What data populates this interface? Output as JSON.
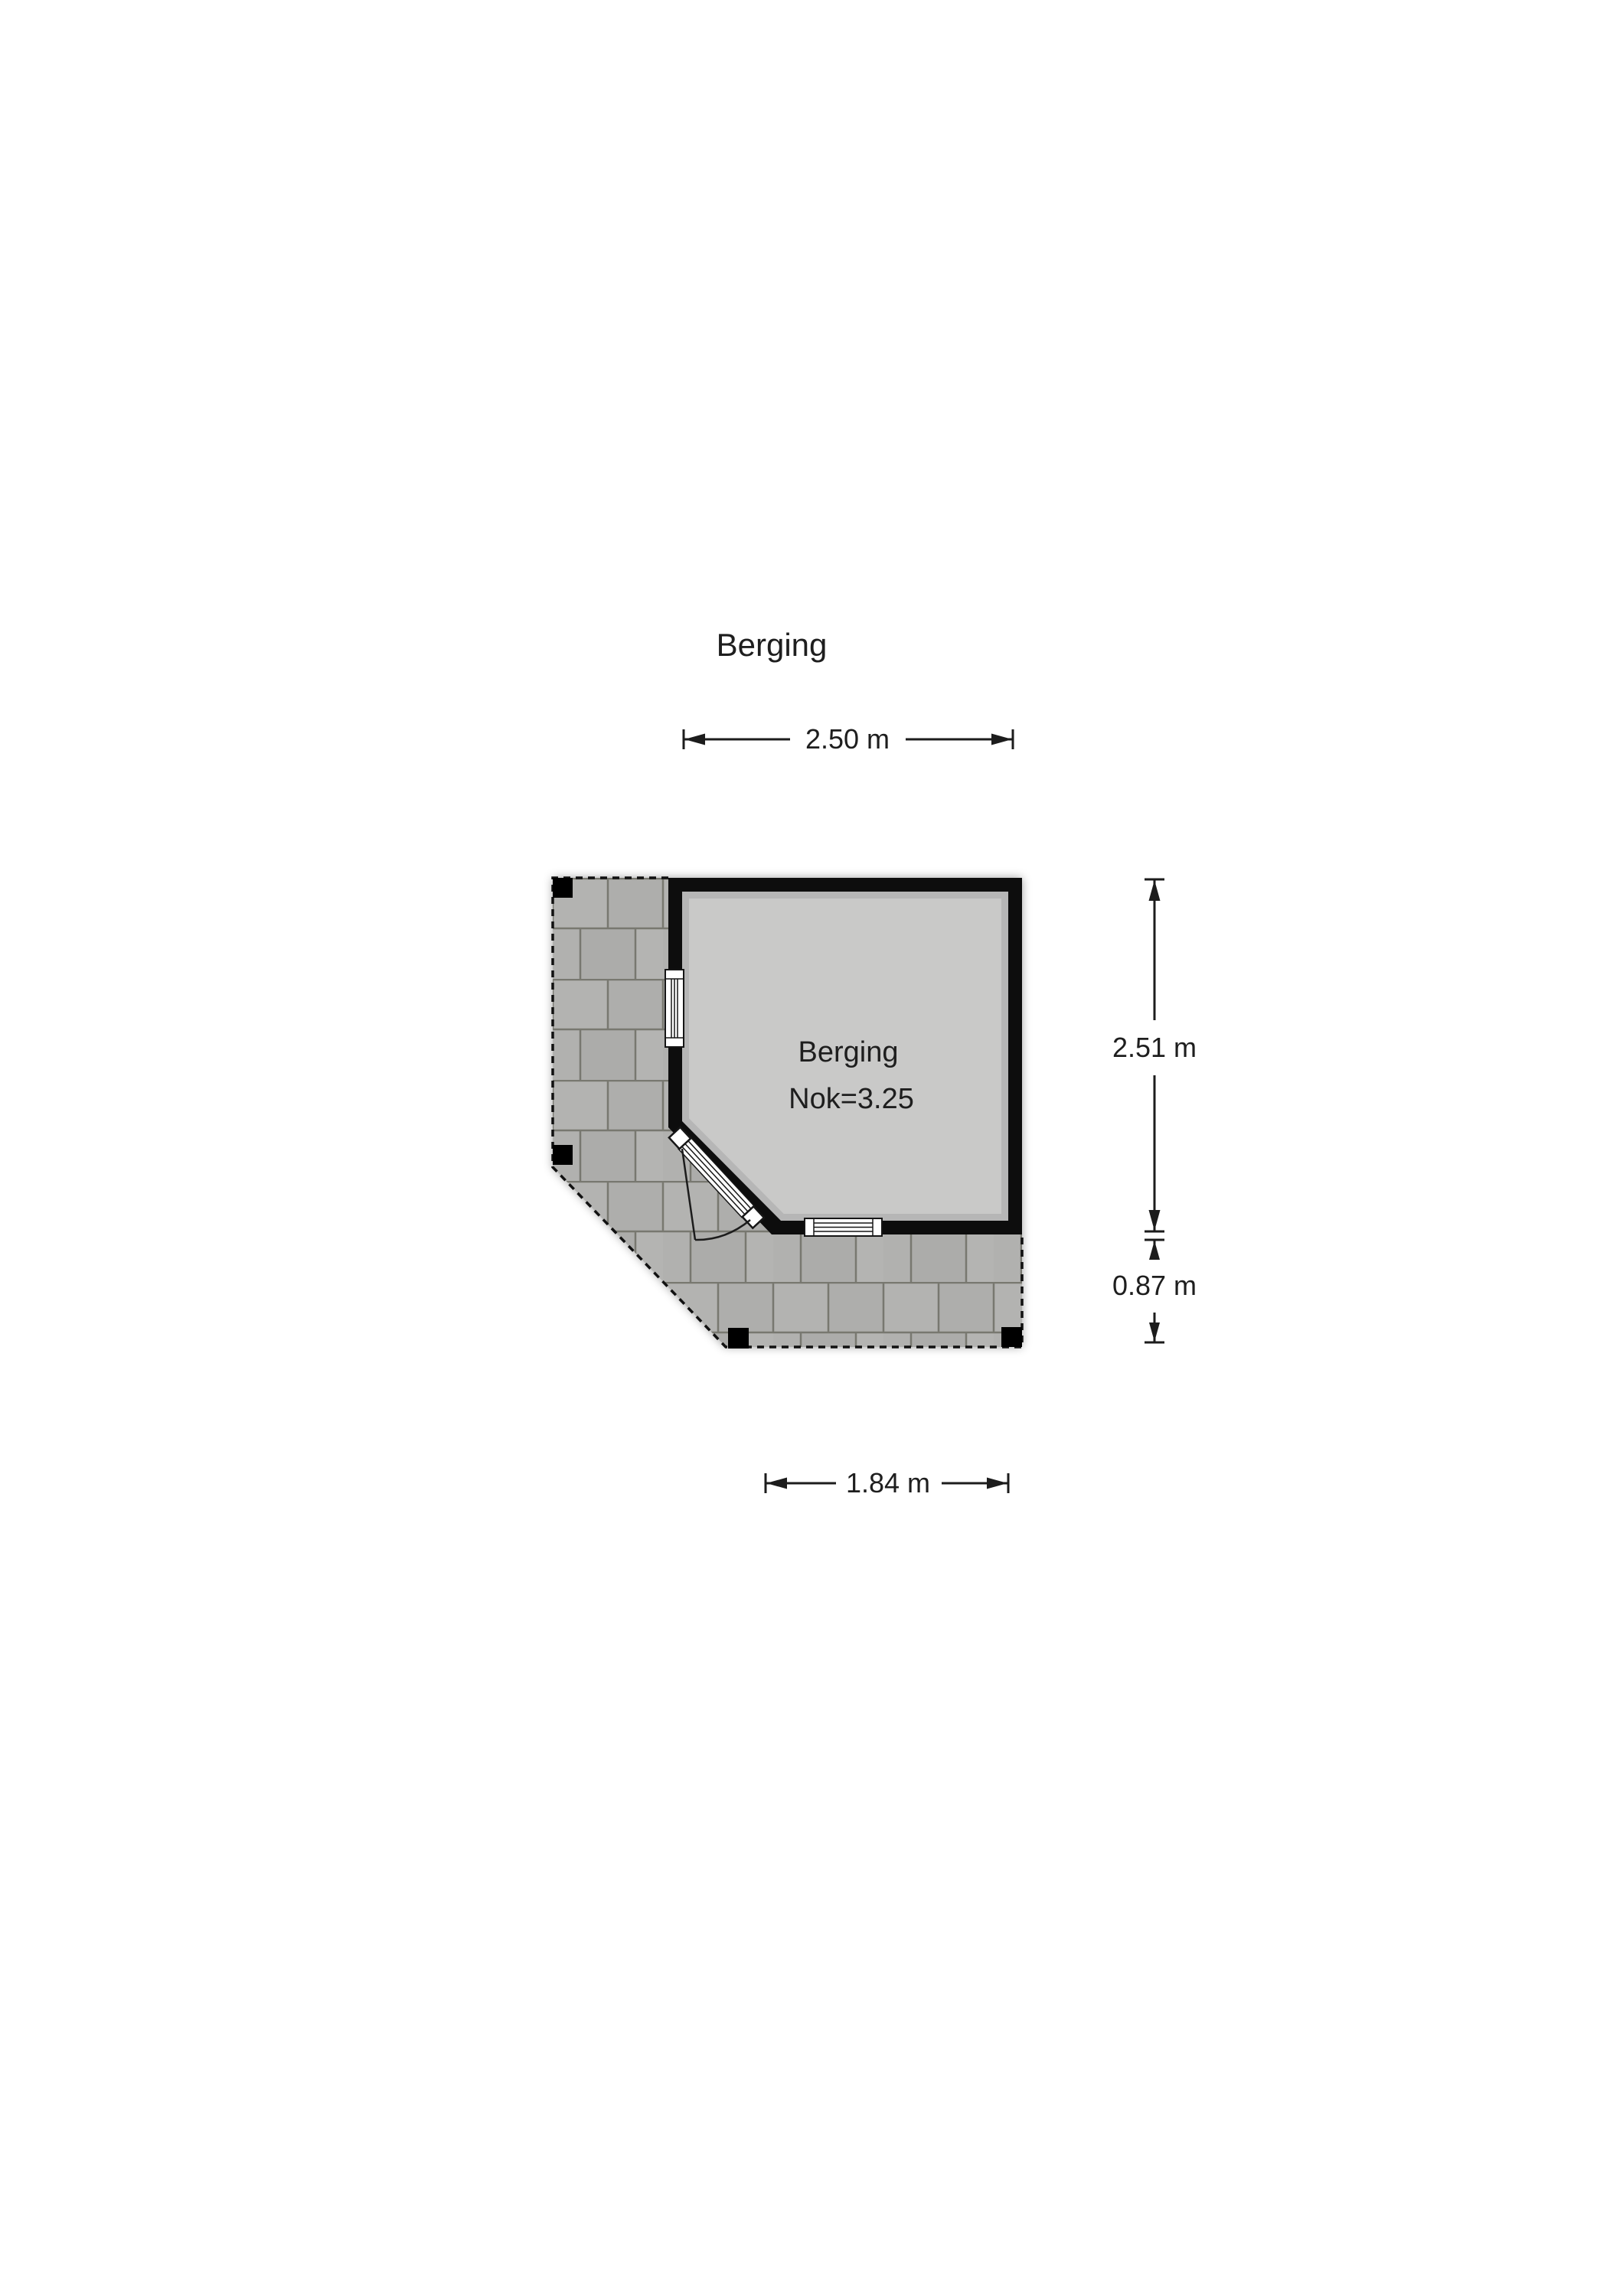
{
  "title": "Berging",
  "room": {
    "name": "Berging",
    "ridge": "Nok=3.25"
  },
  "dimensions": {
    "width_top": "2.50 m",
    "height_right": "2.51 m",
    "terrace_depth_right": "0.87 m",
    "width_bottom": "1.84 m"
  },
  "colors": {
    "background": "#ffffff",
    "wall": "#0a0a0a",
    "room_fill": "#c9c9c8",
    "terrace_tile": "#b0b0ae",
    "terrace_joint": "#78786f",
    "dimension_lines": "#1c1c1c",
    "text": "#1e1e1e"
  }
}
